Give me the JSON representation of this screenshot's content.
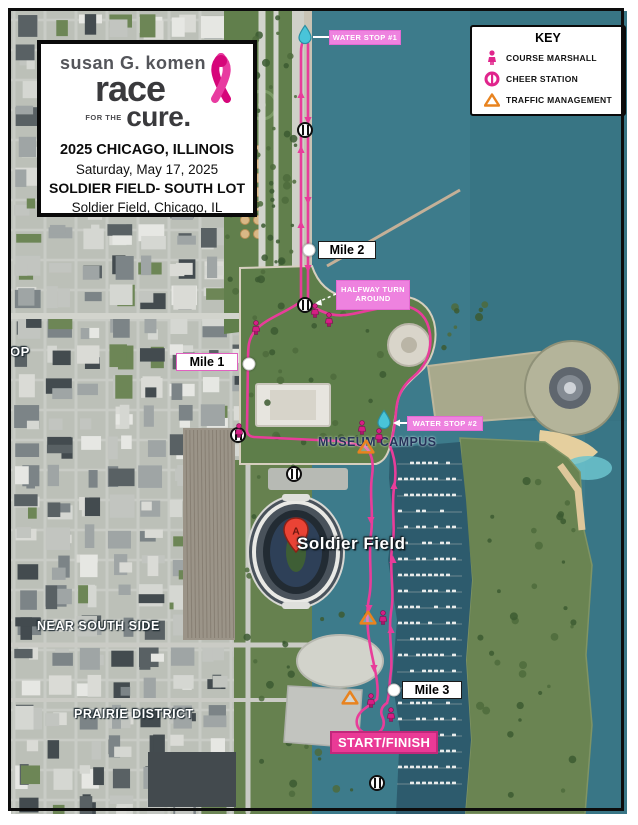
{
  "info_box": {
    "brand": {
      "top": "susan G. komen",
      "race": "race",
      "for_the": "FOR THE",
      "cure": "cure."
    },
    "lines": [
      "2025 CHICAGO, ILLINOIS",
      "Saturday, May 17, 2025",
      "SOLDIER FIELD- SOUTH LOT",
      "Soldier Field, Chicago, IL"
    ]
  },
  "key": {
    "title": "KEY",
    "items": [
      {
        "icon": "course-marshall-icon",
        "label": "COURSE MARSHALL"
      },
      {
        "icon": "cheer-station-icon",
        "label": "CHEER STATION"
      },
      {
        "icon": "traffic-management-icon",
        "label": "TRAFFIC MANAGEMENT"
      }
    ]
  },
  "map": {
    "labels": {
      "water_stop_1": "WATER STOP #1",
      "water_stop_2": "WATER STOP #2",
      "halfway": "HALFWAY TURN AROUND",
      "mile_1": "Mile 1",
      "mile_2": "Mile 2",
      "mile_3": "Mile 3",
      "start_finish": "START/FINISH",
      "museum_campus": "MUSEUM CAMPUS",
      "soldier_field": "Soldier Field",
      "near_south_side": "NEAR SOUTH SIDE",
      "prairie_district": "PRAIRIE DISTRICT",
      "loop_partial": "OP",
      "map_pin": "A"
    },
    "markers": {
      "water_stops": [
        {
          "x": 305,
          "y": 37
        },
        {
          "x": 384,
          "y": 422
        }
      ],
      "mile_dots": [
        {
          "x": 249,
          "y": 364
        },
        {
          "x": 309,
          "y": 250
        },
        {
          "x": 394,
          "y": 690
        }
      ],
      "cheer_stations": [
        {
          "x": 305,
          "y": 130
        },
        {
          "x": 305,
          "y": 289
        },
        {
          "x": 238,
          "y": 403
        },
        {
          "x": 294,
          "y": 426
        },
        {
          "x": 377,
          "y": 719
        }
      ],
      "course_marshalls": [
        {
          "x": 315,
          "y": 313
        },
        {
          "x": 329,
          "y": 322
        },
        {
          "x": 256,
          "y": 330
        },
        {
          "x": 239,
          "y": 433
        },
        {
          "x": 362,
          "y": 430
        },
        {
          "x": 379,
          "y": 438
        },
        {
          "x": 383,
          "y": 620
        },
        {
          "x": 371,
          "y": 703
        },
        {
          "x": 391,
          "y": 717
        }
      ],
      "traffic_management": [
        {
          "x": 366,
          "y": 449
        },
        {
          "x": 368,
          "y": 620
        },
        {
          "x": 350,
          "y": 700
        }
      ]
    },
    "colors": {
      "route_pink": "#e83d9a",
      "label_pink": "#ee82df",
      "start_finish_pink": "#ea3a96",
      "ribbon_pink": "#d6067a",
      "water_drop_teal": "#49c4d9",
      "traffic_orange": "#e8831f",
      "lake_water": "#3d7b8b",
      "harbor_water": "#2d5b6d"
    }
  }
}
